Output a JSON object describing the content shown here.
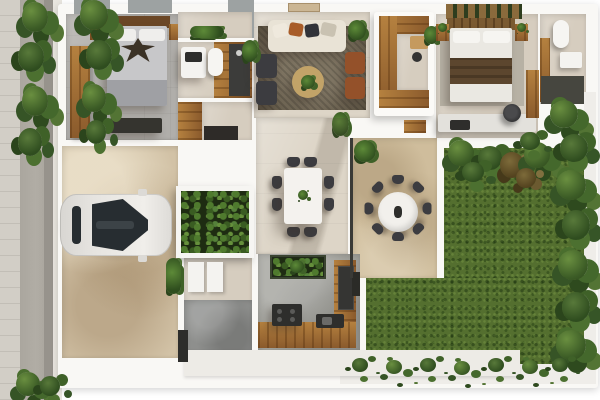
{
  "meta": {
    "title": "Top-down 3D architectural floor plan render",
    "description": "Photoreal top view of a single-storey house: two bedrooms with en-suite bathrooms, living room, walk-in closet, dining room, kitchen, entry stairs, carport with parked car, stone terrace with round outdoor dining set, and a large grass garden bordered by hedges. Street with planted verge on the left.",
    "image_text": []
  },
  "palette": {
    "bg": "#ffffff",
    "wall": "#f9f8f5",
    "white": "#f4f3f0",
    "tileGray": "#b0aeaa",
    "tileLight": "#ddd5c7",
    "tileBeige": "#d6cdbf",
    "terrace": "#cfbd9c",
    "carportFloor": "#d2c2a6",
    "cement": "#8e8f8d",
    "kitchenFloor": "#9f9f99",
    "lawn": "#546f2f",
    "woodLight": "#b5813f",
    "woodDark": "#8a5a2c",
    "rug": "#6f6450",
    "charcoal": "#3c3c40",
    "leather": "#94512a",
    "darkFixture": "#2e2e2c",
    "carBody": "#e6e4e0",
    "carGlass": "#272d31",
    "road": "#b1ada5",
    "sidewalk": "#d2cec6",
    "roofSlab": "#9da2a2",
    "duvetGray": "#c7c7c9",
    "duvetWhite": "#eae8e2",
    "throwBrown": "#5c462e",
    "marble": "#e3e1dc",
    "sofaCream": "#e9e3d6",
    "pillowRust": "#a85c28",
    "tableGold": "#c2a368",
    "planterGreen": "#1e2c12"
  },
  "scene": {
    "rooms": [
      {
        "id": "bedroom-1",
        "name": "master bedroom",
        "items": [
          "double bed with gray duvet and eagle-print throw",
          "wood wardrobe",
          "two nightstands",
          "foot bench"
        ]
      },
      {
        "id": "bathroom-1",
        "name": "en-suite bathroom 1",
        "items": [
          "vanity sink",
          "toilet",
          "dark-floor shower",
          "green wall strip"
        ]
      },
      {
        "id": "living-room",
        "name": "living room",
        "items": [
          "cream sofa with pillows",
          "two charcoal armchairs",
          "two leather chairs",
          "round gold coffee table with plant",
          "area rug",
          "potted plants"
        ]
      },
      {
        "id": "walk-in-closet",
        "name": "walk-in closet",
        "items": [
          "C-shaped wood shelving",
          "vanity desk",
          "stool"
        ]
      },
      {
        "id": "bedroom-2",
        "name": "bedroom 2",
        "items": [
          "double bed with white duvet and brown throw",
          "slatted pergola",
          "two nightstands with plants",
          "marble desk",
          "black office chair",
          "wood wardrobe strip"
        ]
      },
      {
        "id": "bathroom-2",
        "name": "en-suite bathroom 2",
        "items": [
          "toilet",
          "vanity",
          "dark-floor shower"
        ]
      },
      {
        "id": "dining-room",
        "name": "dining room",
        "items": [
          "white rectangular table",
          "eight dark chairs"
        ]
      },
      {
        "id": "kitchen",
        "name": "kitchen",
        "items": [
          "L-shaped wood counter",
          "black cooking island",
          "dark tall unit",
          "herb planter"
        ]
      },
      {
        "id": "entry",
        "name": "entry / foyer",
        "items": [
          "two steps",
          "cement floor",
          "dark accent wall",
          "large planter box"
        ]
      },
      {
        "id": "carport",
        "name": "carport",
        "items": [
          "white car (top view)"
        ]
      },
      {
        "id": "terrace",
        "name": "terrace",
        "items": [
          "round outdoor table",
          "eight outdoor chairs",
          "corner plant",
          "black glazing frame"
        ]
      },
      {
        "id": "garden",
        "name": "garden",
        "items": [
          "grass lawn",
          "hedge row",
          "side hedge over white wall",
          "grass fringe on south wall"
        ]
      },
      {
        "id": "street",
        "name": "street edge",
        "items": [
          "sidewalk",
          "road strip",
          "planted verge",
          "neighbor roof slab with vines"
        ]
      }
    ]
  }
}
